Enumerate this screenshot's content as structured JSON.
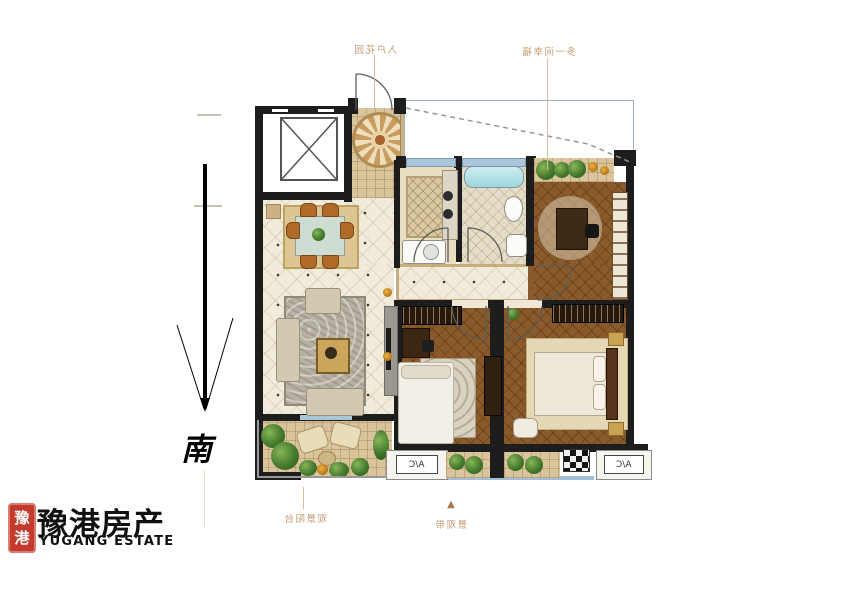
{
  "page": {
    "background_color": "#ffffff"
  },
  "compass": {
    "south_label": "南"
  },
  "plan_annotations": {
    "entry_garden_label": "入户花园",
    "extra_room_label": "多一间幸福",
    "view_balcony_label": "观景阳台",
    "landscape_label": "景观带",
    "direction_marker": "▲",
    "ac_platform_left": "A/C",
    "ac_platform_right": "A/C",
    "labels_rendered_mirrored": true
  },
  "logo": {
    "seal_text": "豫港",
    "company_name_cn": "豫港房产",
    "company_name_en": "YUGANG ESTATE",
    "seal_color": "#c43a2c"
  },
  "colors": {
    "wall": "#1d1d1d",
    "label_tan": "#c49b74",
    "cream_tile": "#f1ebdb",
    "wood_floor": "#8a5a2b",
    "balcony_tile": "#d9c49c",
    "window_blue": "#a9c6da",
    "bathtub_cyan": "#b7e2e6"
  }
}
